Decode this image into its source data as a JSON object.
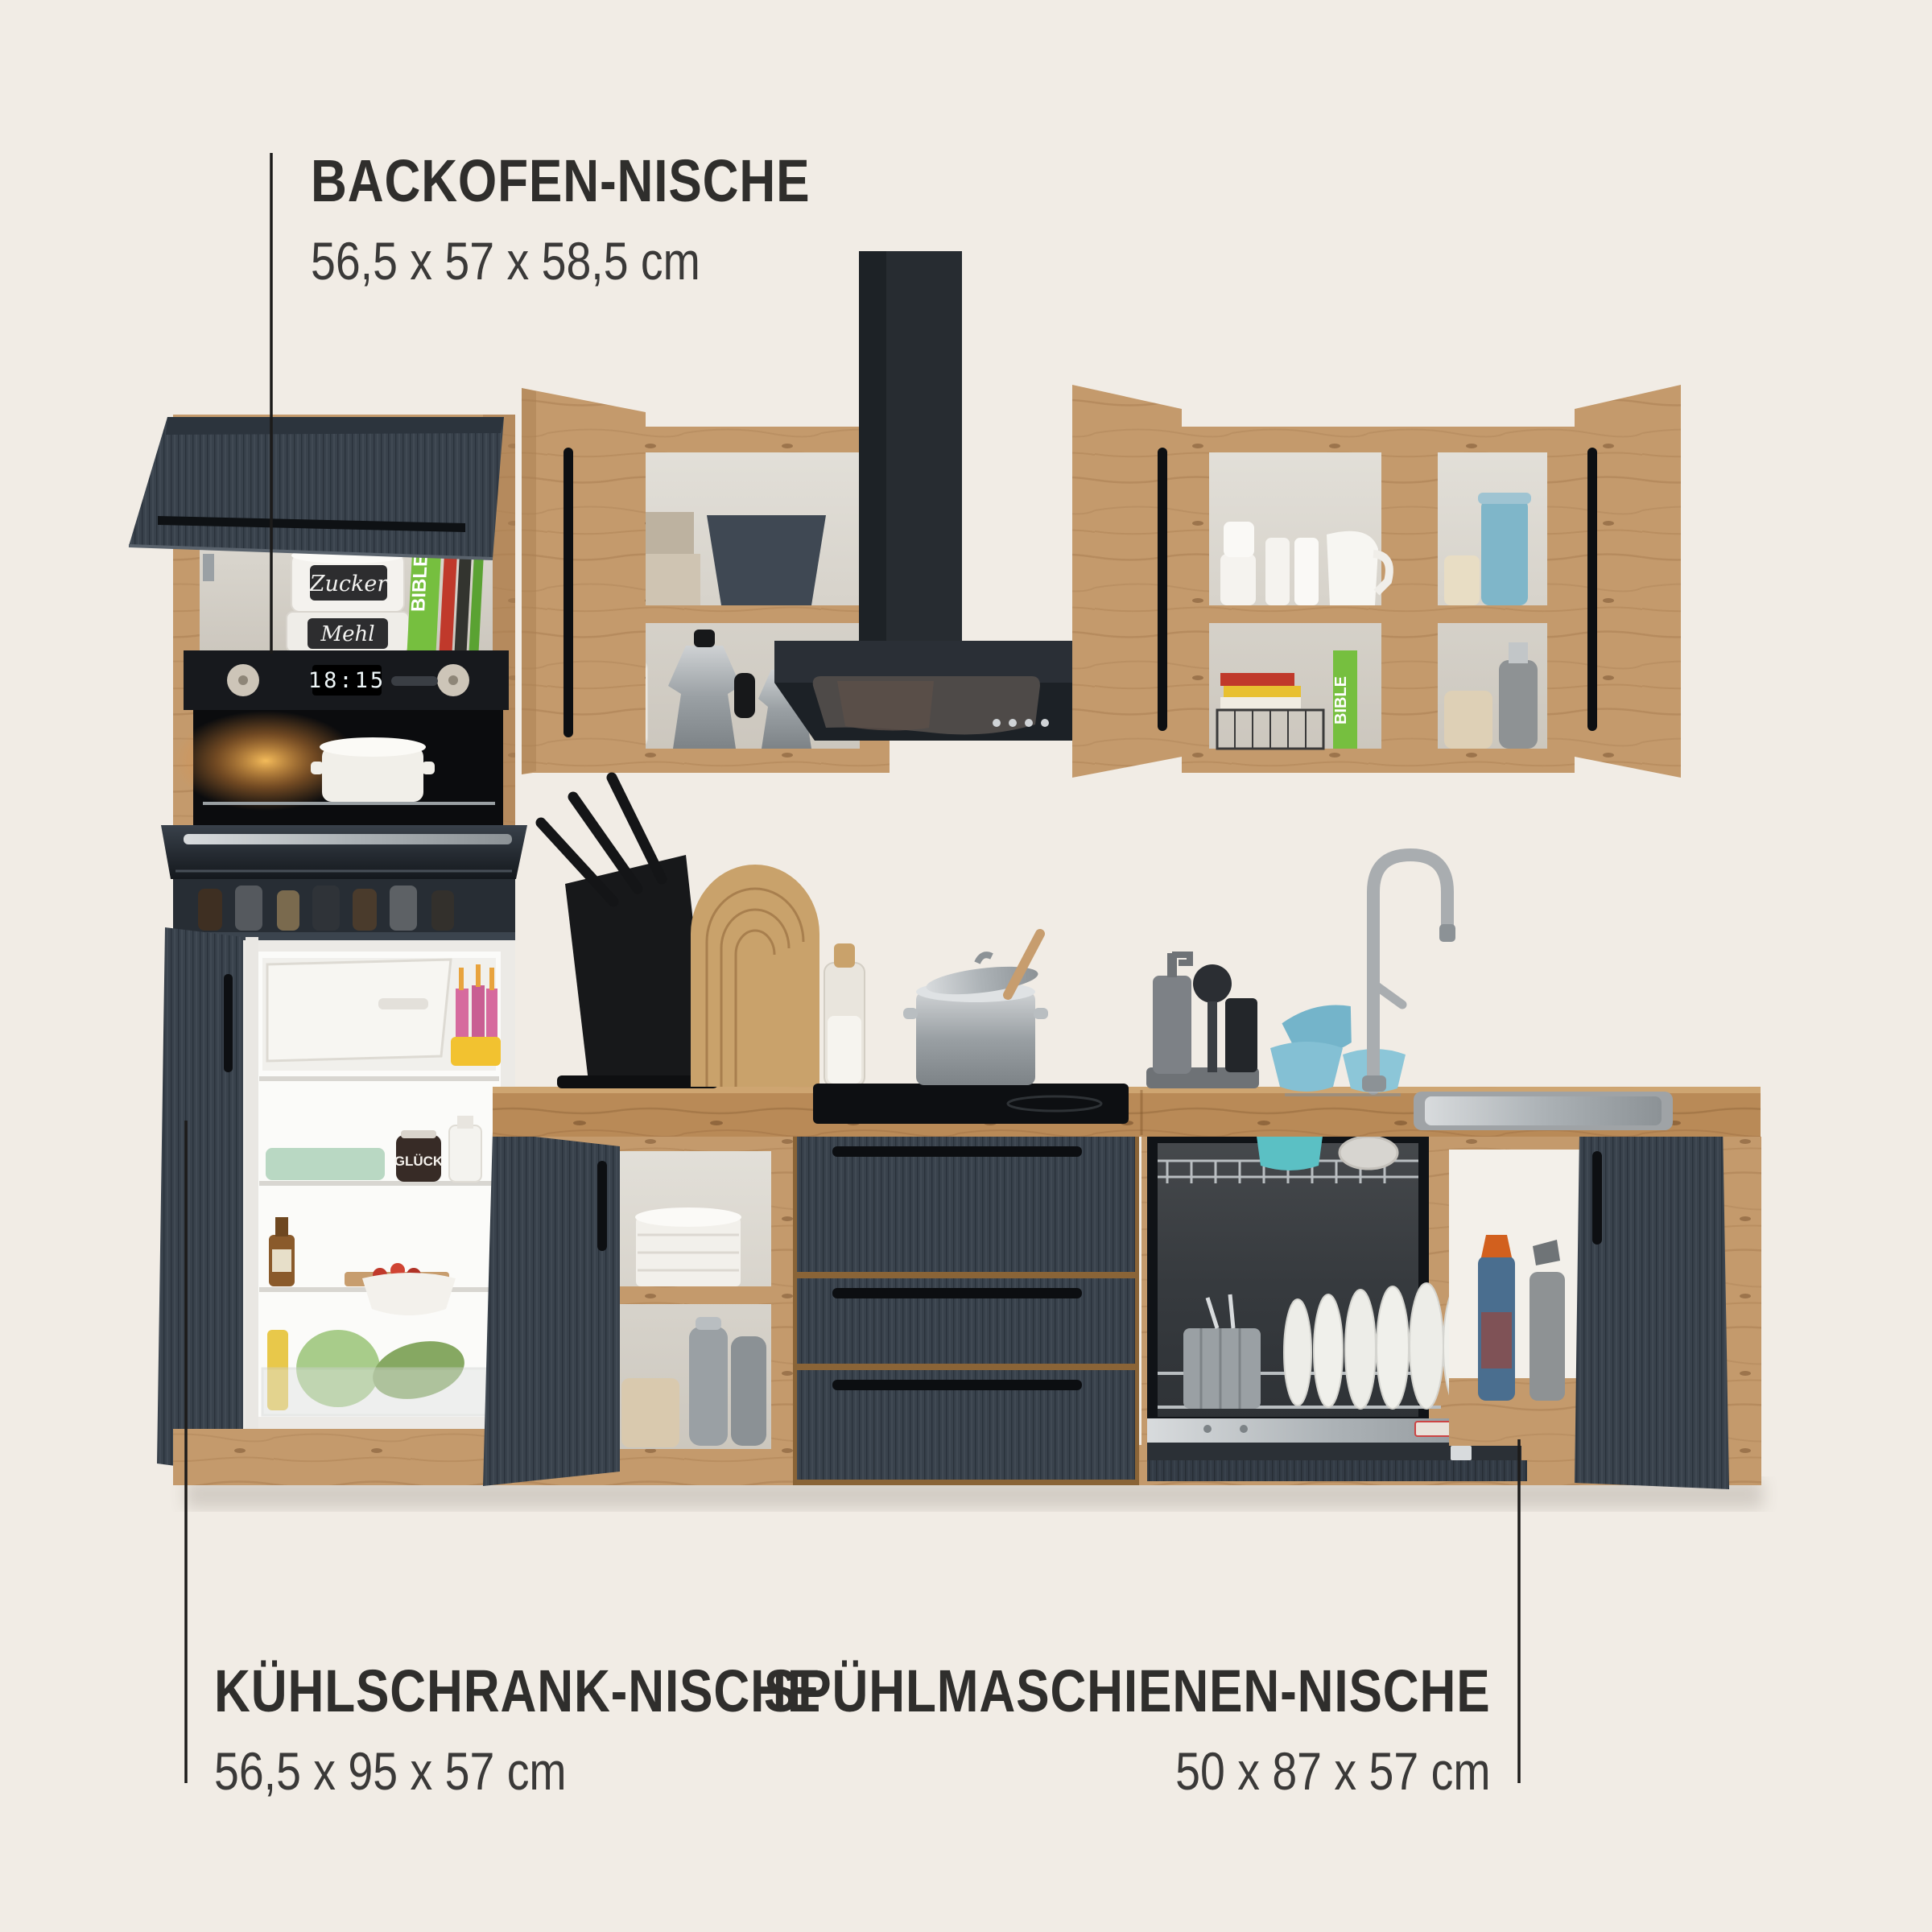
{
  "image_type": "kitchen product photo with dimension annotations",
  "background_color": "#f1ece5",
  "annotations": {
    "backofen": {
      "title": "BACKOFEN-NISCHE",
      "dimensions": "56,5 x 57 x 58,5 cm"
    },
    "kuehlschrank": {
      "title": "KÜHLSCHRANK-NISCHE",
      "dimensions": "56,5 x 95 x 57 cm"
    },
    "spuelmaschine": {
      "title": "SPÜHLMASCHIENEN-NISCHE",
      "dimensions": "50 x 87 x 57 cm"
    }
  },
  "scene": {
    "oven_display": "18:15",
    "tin_top": "Zucker",
    "tin_bottom": "Mehl",
    "book_spine": "BIBLE",
    "canister_label": "TWINE",
    "jar_label": "GLÜCK",
    "colors": {
      "oak": "#c49a6c",
      "oak_dark": "#a97f52",
      "worktop": "#b98a57",
      "anthracite_front": "#39424c",
      "appliance_black": "#1b1f24",
      "steel": "#9aa0a4",
      "teal_bowls": "#84c0d4",
      "label_text": "#2f2e2c",
      "leader_line": "#1c1b1a"
    }
  }
}
